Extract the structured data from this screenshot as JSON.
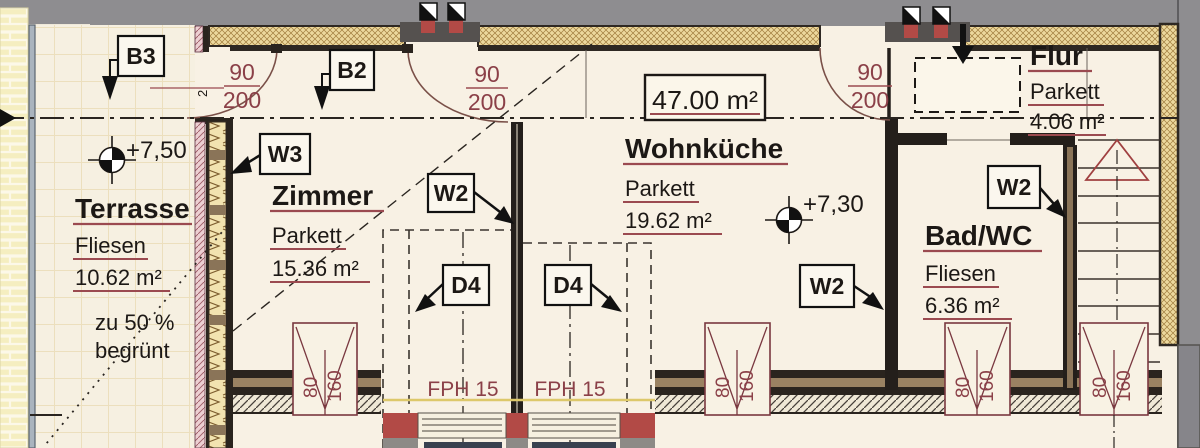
{
  "drawing": {
    "total_area": "47.00 m²",
    "fph_label": "FPH 15",
    "levels": {
      "terrace": "+7,50",
      "living": "+7,30"
    },
    "door_dim": {
      "w": "90",
      "h": "200",
      "note": "2"
    },
    "window_dim": {
      "w": "80",
      "h": "160"
    },
    "rooms": {
      "terrasse": {
        "name": "Terrasse",
        "floor": "Fliesen",
        "area": "10.62 m²",
        "note1": "zu 50 %",
        "note2": "begrünt"
      },
      "zimmer": {
        "name": "Zimmer",
        "floor": "Parkett",
        "area": "15.36 m²"
      },
      "wohnkueche": {
        "name": "Wohnküche",
        "floor": "Parkett",
        "area": "19.62 m²"
      },
      "bad": {
        "name": "Bad/WC",
        "floor": "Fliesen",
        "area": "6.36 m²"
      },
      "flur": {
        "name": "Flur",
        "floor": "Parkett",
        "area": "4.06 m²"
      }
    },
    "tags": {
      "b3": "B3",
      "b2": "B2",
      "w3": "W3",
      "w2": "W2",
      "d4": "D4"
    },
    "colors": {
      "dim_red": "#8b4048",
      "wall_dark": "#241f1b",
      "accent_red": "#b24a46",
      "insulation_tan": "#ead797",
      "exterior_gray": "#8e8d90"
    }
  }
}
